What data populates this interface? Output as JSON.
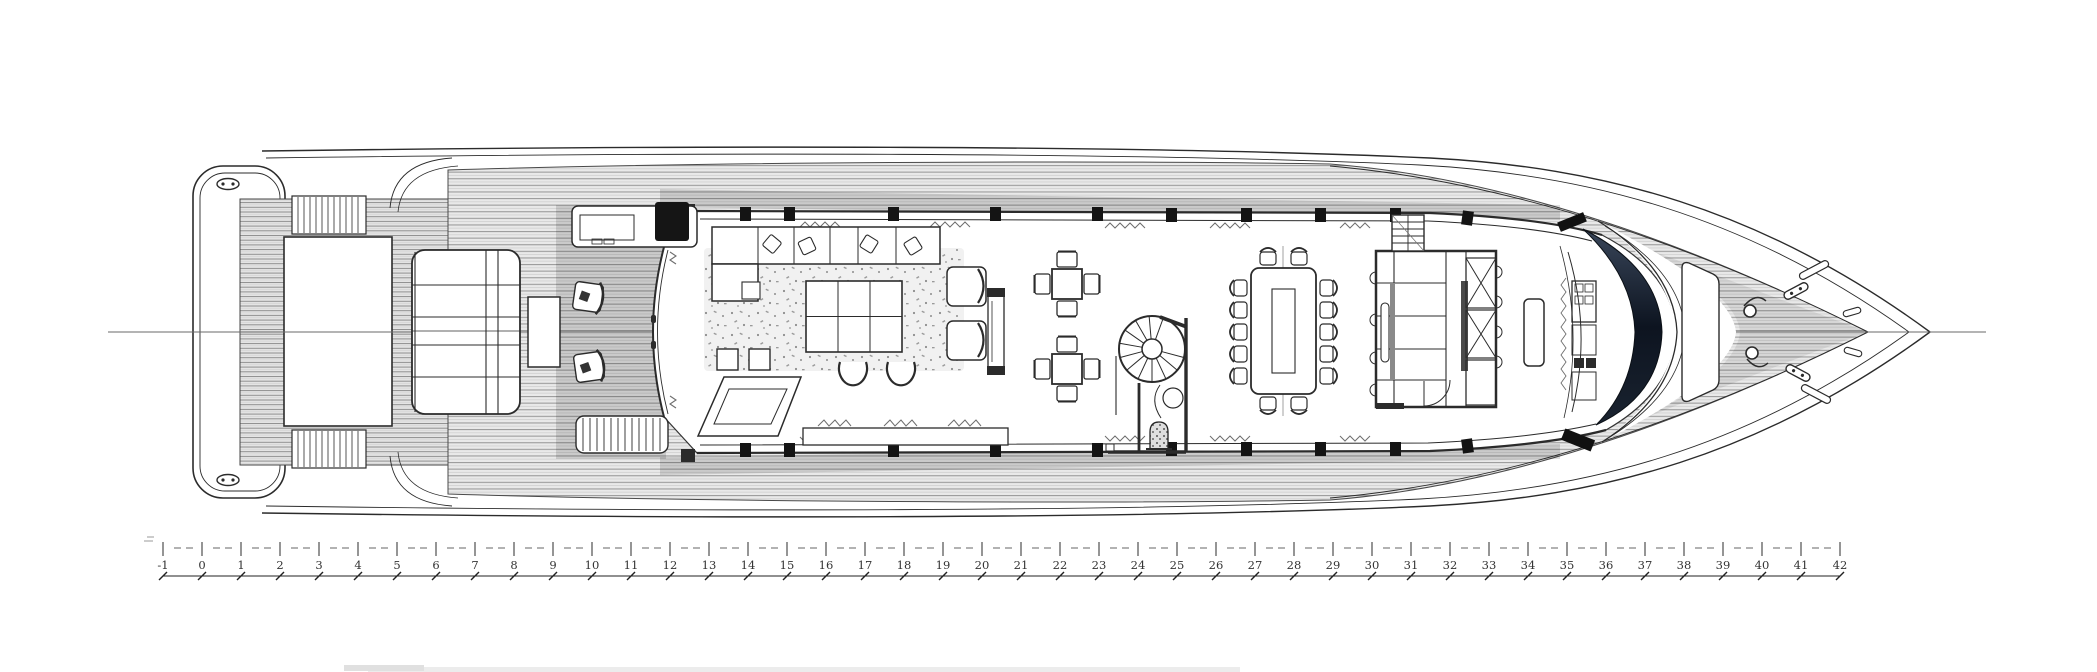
{
  "diagram": {
    "kind": "yacht-deck-floorplan",
    "orientation": "bow-right",
    "colors": {
      "background": "#ffffff",
      "line": "#2b2b2b",
      "deck_fill": "#e9e9e9",
      "deck_stripe": "#9b9b9b",
      "shadow": "rgba(0,0,0,0.13)",
      "windshield_dark": "#0d1420",
      "windshield_light": "#39465a",
      "ruler_text": "#333333"
    }
  },
  "ruler": {
    "labels": [
      "-1",
      "0",
      "1",
      "2",
      "3",
      "4",
      "5",
      "6",
      "7",
      "8",
      "9",
      "10",
      "11",
      "12",
      "13",
      "14",
      "15",
      "16",
      "17",
      "18",
      "19",
      "20",
      "21",
      "22",
      "23",
      "24",
      "25",
      "26",
      "27",
      "28",
      "29",
      "30",
      "31",
      "32",
      "33",
      "34",
      "35",
      "36",
      "37",
      "38",
      "39",
      "40",
      "41",
      "42"
    ]
  }
}
